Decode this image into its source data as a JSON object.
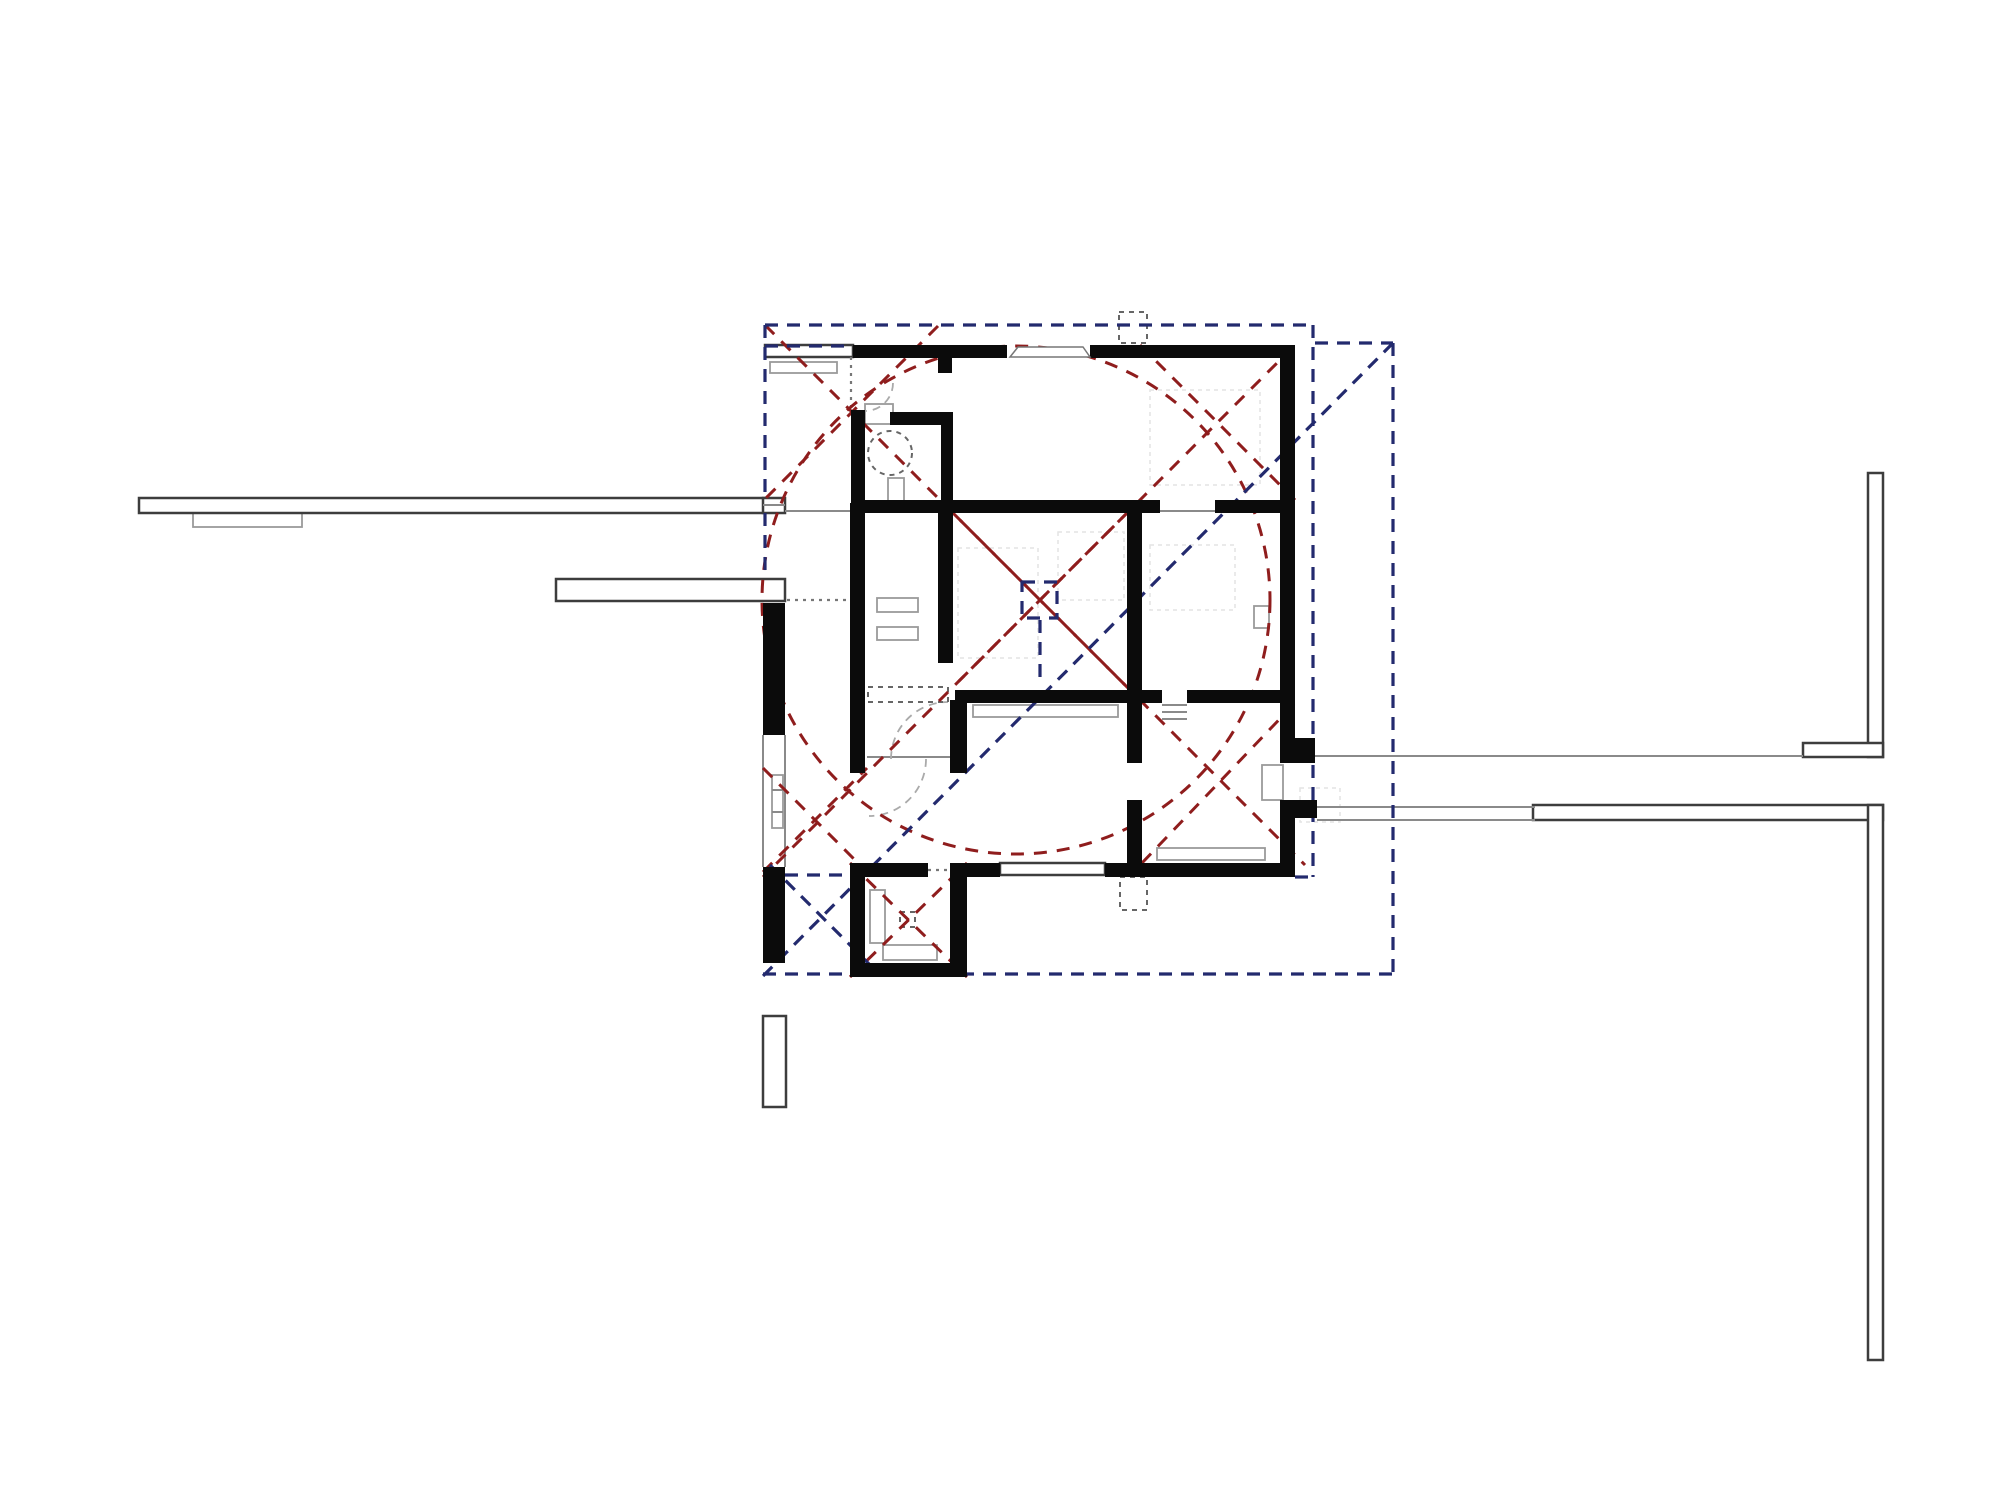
{
  "meta": {
    "width": 2000,
    "height": 1500,
    "background": "#ffffff",
    "drawing_type": "architectural-floor-plan"
  },
  "colors": {
    "wall": "#0b0b0b",
    "red_dashed": "#8f1d1d",
    "blue_dashed": "#232a6e",
    "gray_line": "#8a8a8a",
    "outline_dark": "#3d3d3d",
    "furniture": "#9a9a9a"
  },
  "layers": [
    {
      "name": "faint-grid-rects",
      "type": "rect",
      "class": "faint",
      "items": [
        [
          1150,
          390,
          110,
          95
        ],
        [
          1058,
          532,
          66,
          68
        ],
        [
          1150,
          545,
          85,
          65
        ],
        [
          958,
          548,
          80,
          110
        ],
        [
          1300,
          788,
          40,
          34
        ]
      ]
    },
    {
      "name": "furniture-rects",
      "type": "rect",
      "class": "furn",
      "items": [
        [
          770,
          362,
          67,
          11
        ],
        [
          193,
          513,
          109,
          14
        ],
        [
          877,
          598,
          41,
          14
        ],
        [
          877,
          627,
          41,
          13
        ],
        [
          973,
          705,
          145,
          12
        ],
        [
          1254,
          606,
          15,
          22
        ],
        [
          1157,
          848,
          108,
          12
        ],
        [
          870,
          890,
          15,
          53
        ],
        [
          883,
          945,
          54,
          15
        ],
        [
          772,
          775,
          11,
          53
        ],
        [
          1262,
          765,
          21,
          35
        ],
        [
          888,
          478,
          16,
          23
        ],
        [
          865,
          404,
          28,
          20
        ]
      ]
    },
    {
      "name": "exterior-outlined-walls",
      "type": "rect",
      "class": "outlined",
      "items": [
        [
          139,
          498,
          626,
          15
        ],
        [
          763,
          498,
          22,
          15
        ],
        [
          556,
          579,
          229,
          22
        ],
        [
          1533,
          805,
          350,
          15
        ],
        [
          1868,
          473,
          15,
          284
        ],
        [
          1803,
          743,
          80,
          14
        ],
        [
          1868,
          805,
          15,
          555
        ],
        [
          763,
          1016,
          23,
          91
        ],
        [
          1000,
          863,
          105,
          12
        ],
        [
          765,
          345,
          88,
          12
        ]
      ]
    },
    {
      "name": "gray-lines",
      "type": "line",
      "class": "gline",
      "items": [
        [
          785,
          511,
          852,
          511
        ],
        [
          763,
          505,
          785,
          505
        ],
        [
          1315,
          756,
          1803,
          756
        ],
        [
          1317,
          807,
          1535,
          807
        ],
        [
          1317,
          820,
          1535,
          820
        ],
        [
          867,
          757,
          950,
          757
        ],
        [
          1160,
          511,
          1215,
          511
        ],
        [
          1162,
          705,
          1187,
          705
        ],
        [
          1162,
          712,
          1187,
          712
        ],
        [
          1162,
          719,
          1187,
          719
        ],
        [
          763,
          735,
          763,
          867
        ],
        [
          785,
          735,
          785,
          867
        ],
        [
          772,
          790,
          783,
          790
        ],
        [
          772,
          812,
          783,
          812
        ]
      ]
    },
    {
      "name": "gray-dotted-lines",
      "type": "line",
      "class": "dotline",
      "items": [
        [
          851,
          357,
          851,
          410
        ],
        [
          787,
          600,
          850,
          600
        ],
        [
          928,
          870,
          950,
          870
        ]
      ]
    },
    {
      "name": "door-swing-arcs",
      "type": "path",
      "class": "garc",
      "items": [
        "M 893 383 A 28 28 0 0 1 865 411",
        "M 926 759 A 57 57 0 0 1 869 816",
        "M 891 759 A 57 57 0 0 1 948 702"
      ]
    },
    {
      "name": "gray-dashed-rects",
      "type": "rect",
      "class": "gdash",
      "items": [
        [
          1119,
          312,
          28,
          31
        ],
        [
          1120,
          877,
          27,
          33
        ],
        [
          900,
          912,
          15,
          15
        ],
        [
          868,
          687,
          80,
          15
        ]
      ]
    },
    {
      "name": "gray-dashed-circles",
      "type": "circle",
      "class": "gdash",
      "items": [
        [
          890,
          453,
          22
        ]
      ]
    },
    {
      "name": "red-dashed-circle",
      "type": "circle",
      "class": "rdash",
      "items": [
        [
          1016,
          600,
          254
        ]
      ]
    },
    {
      "name": "red-dashed-lines",
      "type": "line",
      "class": "rdash",
      "items": [
        [
          765,
          325,
          1305,
          865
        ],
        [
          938,
          326,
          765,
          499
        ],
        [
          1293,
          347,
          953,
          687
        ],
        [
          1140,
          345,
          1295,
          500
        ],
        [
          1127,
          513,
          763,
          877
        ],
        [
          953,
          513,
          1127,
          687
        ],
        [
          1142,
          863,
          1295,
          703
        ],
        [
          850,
          863,
          967,
          977
        ],
        [
          850,
          977,
          967,
          863
        ],
        [
          763,
          768,
          867,
          872
        ],
        [
          763,
          872,
          867,
          768
        ]
      ]
    },
    {
      "name": "blue-dashed-lines",
      "type": "line",
      "class": "bdash",
      "items": [
        [
          765,
          325,
          1313,
          325
        ],
        [
          1313,
          325,
          1313,
          877
        ],
        [
          1295,
          877,
          1313,
          877
        ],
        [
          1315,
          343,
          1393,
          343
        ],
        [
          1393,
          343,
          1393,
          974
        ],
        [
          763,
          974,
          1393,
          974
        ],
        [
          765,
          325,
          765,
          498
        ],
        [
          765,
          513,
          765,
          579
        ],
        [
          785,
          875,
          850,
          875
        ],
        [
          765,
          346,
          850,
          346
        ],
        [
          1393,
          343,
          763,
          976
        ],
        [
          770,
          865,
          880,
          975
        ],
        [
          1040,
          620,
          1040,
          685
        ]
      ]
    },
    {
      "name": "blue-dashed-rects",
      "type": "rect",
      "class": "bdash",
      "items": [
        [
          1022,
          582,
          35,
          36
        ]
      ]
    },
    {
      "name": "walls",
      "type": "rect",
      "class": "wall",
      "items": [
        [
          853,
          345,
          154,
          13
        ],
        [
          1090,
          345,
          205,
          13
        ],
        [
          938,
          358,
          14,
          15
        ],
        [
          1280,
          345,
          15,
          418
        ],
        [
          1293,
          738,
          22,
          25
        ],
        [
          1280,
          800,
          15,
          77
        ],
        [
          1295,
          800,
          22,
          18
        ],
        [
          1105,
          863,
          190,
          14
        ],
        [
          950,
          863,
          50,
          14
        ],
        [
          850,
          863,
          15,
          114
        ],
        [
          865,
          863,
          63,
          14
        ],
        [
          850,
          963,
          117,
          14
        ],
        [
          950,
          863,
          17,
          114
        ],
        [
          763,
          603,
          22,
          132
        ],
        [
          763,
          867,
          22,
          96
        ],
        [
          850,
          503,
          15,
          270
        ],
        [
          851,
          410,
          14,
          93
        ],
        [
          890,
          412,
          63,
          13
        ],
        [
          941,
          412,
          12,
          91
        ],
        [
          853,
          500,
          307,
          13
        ],
        [
          1215,
          500,
          65,
          13
        ],
        [
          938,
          513,
          15,
          150
        ],
        [
          955,
          690,
          207,
          13
        ],
        [
          1187,
          690,
          93,
          13
        ],
        [
          950,
          700,
          17,
          73
        ],
        [
          1127,
          500,
          15,
          190
        ],
        [
          1127,
          700,
          15,
          63
        ],
        [
          1127,
          800,
          15,
          77
        ]
      ]
    },
    {
      "name": "entry-door-trapezoid",
      "type": "polygon",
      "class": "door",
      "items": [
        "1010,357 1018,347 1083,347 1090,357"
      ]
    }
  ]
}
